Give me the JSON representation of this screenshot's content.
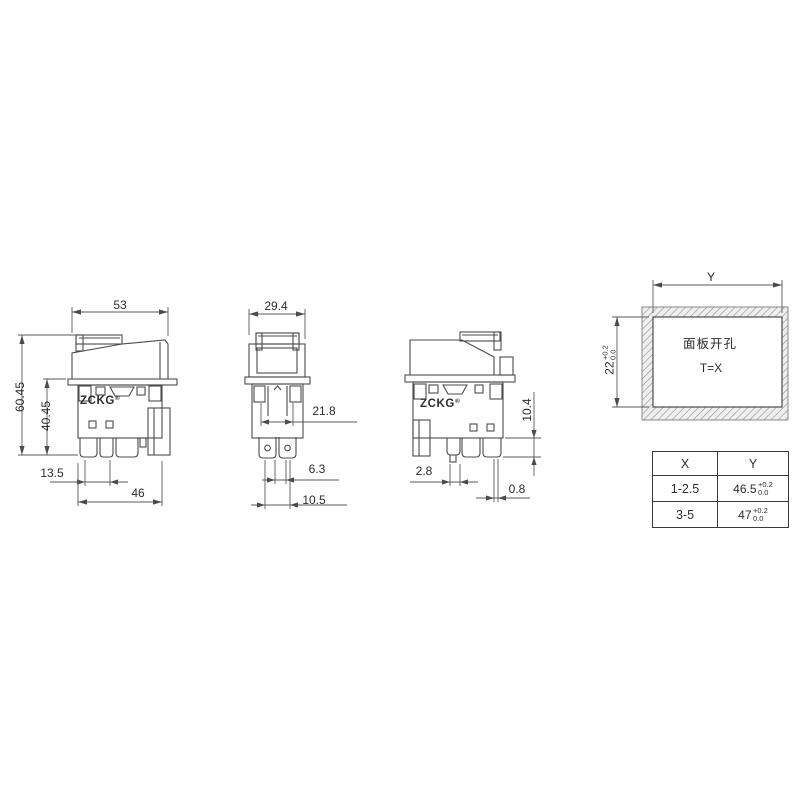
{
  "drawing": {
    "brand": "ZCKG",
    "brand_mark": "®"
  },
  "views": {
    "side_left": {
      "dims": {
        "width_top": "53",
        "height_total": "60.45",
        "height_body": "40.45",
        "offset_bottom": "13.5",
        "width_bottom": "46"
      }
    },
    "front": {
      "dims": {
        "width_top": "29.4",
        "body_width": "21.8",
        "pin_gap": "6.3",
        "pin_span": "10.5"
      }
    },
    "side_right": {
      "dims": {
        "peg_width": "2.8",
        "pin_thickness": "0.8",
        "pin_length": "10.4"
      }
    },
    "panel_cutout": {
      "width_label": "Y",
      "height": {
        "main": "22",
        "tol_top": "+0.2",
        "tol_bottom": "0.0"
      },
      "text_line1": "面板开孔",
      "text_line2": "T=X"
    }
  },
  "table": {
    "headers": [
      "X",
      "Y"
    ],
    "rows": [
      {
        "x": "1-2.5",
        "y_main": "46.5",
        "y_tol_top": "+0.2",
        "y_tol_bottom": "0.0"
      },
      {
        "x": "3-5",
        "y_main": "47",
        "y_tol_top": "+0.2",
        "y_tol_bottom": "0.0"
      }
    ]
  },
  "colors": {
    "line": "#4b4b4b",
    "text": "#2b2b2b",
    "hatch": "#8f8f8f"
  }
}
